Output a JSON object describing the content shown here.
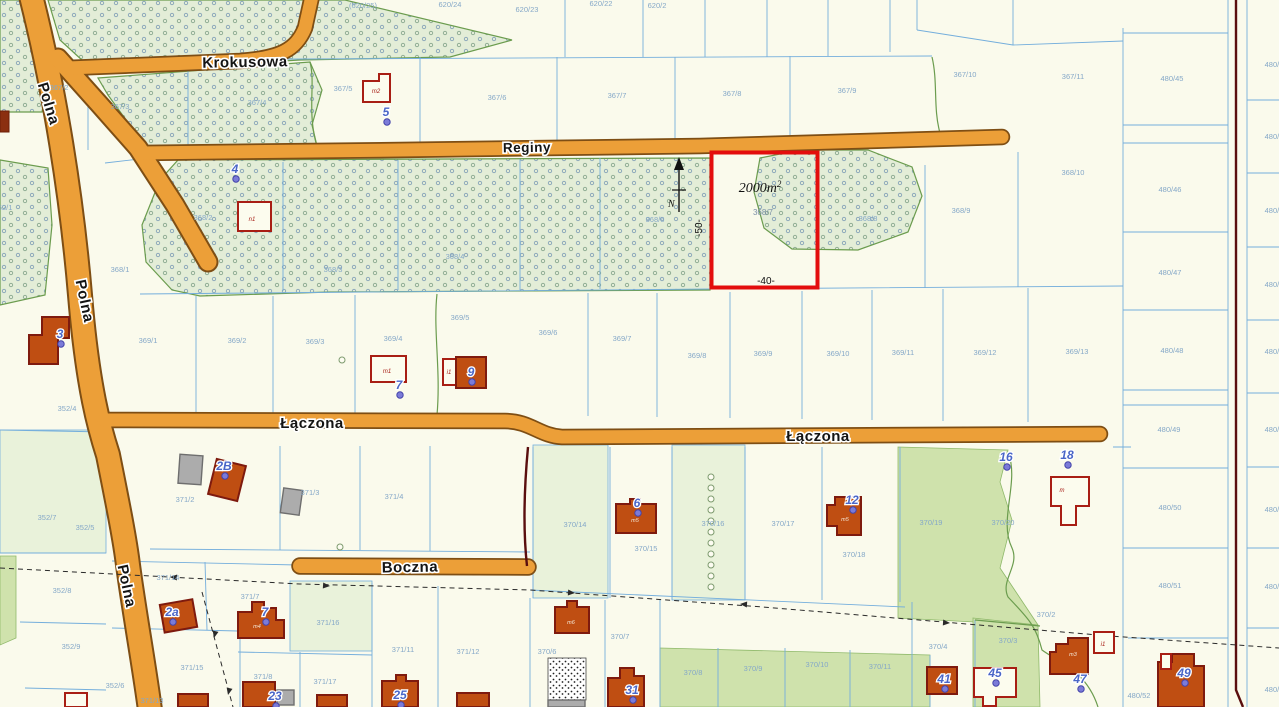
{
  "map": {
    "north": "N",
    "highlight": {
      "area": "2000m",
      "sup": "2",
      "parcel": "368/7",
      "width": "-40-",
      "depth": "-50-",
      "color": "#E30D0D"
    },
    "street_labels": [
      {
        "t": "Krokusowa",
        "x": 245,
        "y": 67,
        "r": -1,
        "s": 15
      },
      {
        "t": "Reginy",
        "x": 527,
        "y": 152,
        "r": -1,
        "s": 13.5
      },
      {
        "t": "Polna",
        "x": 44,
        "y": 105,
        "r": 73,
        "s": 15
      },
      {
        "t": "Polna",
        "x": 80,
        "y": 302,
        "r": 78,
        "s": 15
      },
      {
        "t": "Polna",
        "x": 122,
        "y": 587,
        "r": 78,
        "s": 15
      },
      {
        "t": "Łączona",
        "x": 312,
        "y": 428,
        "r": 0,
        "s": 15
      },
      {
        "t": "Łączona",
        "x": 818,
        "y": 441,
        "r": 0,
        "s": 15
      },
      {
        "t": "Boczna",
        "x": 410,
        "y": 572,
        "r": -1,
        "s": 15
      }
    ],
    "parcel_labels": [
      {
        "t": "(620/25)",
        "x": 363,
        "y": 8
      },
      {
        "t": "620/24",
        "x": 450,
        "y": 7
      },
      {
        "t": "620/23",
        "x": 527,
        "y": 12
      },
      {
        "t": "620/22",
        "x": 601,
        "y": 6
      },
      {
        "t": "620/2",
        "x": 657,
        "y": 8
      },
      {
        "t": "367/2",
        "x": 59,
        "y": 90
      },
      {
        "t": "367/3",
        "x": 120,
        "y": 109
      },
      {
        "t": "367/4",
        "x": 257,
        "y": 105
      },
      {
        "t": "367/5",
        "x": 343,
        "y": 91
      },
      {
        "t": "367/6",
        "x": 497,
        "y": 100
      },
      {
        "t": "367/7",
        "x": 617,
        "y": 98
      },
      {
        "t": "367/8",
        "x": 732,
        "y": 96
      },
      {
        "t": "367/9",
        "x": 847,
        "y": 93
      },
      {
        "t": "367/10",
        "x": 965,
        "y": 77
      },
      {
        "t": "367/11",
        "x": 1073,
        "y": 79
      },
      {
        "t": "368/1",
        "x": 120,
        "y": 272
      },
      {
        "t": "368/2",
        "x": 203,
        "y": 220
      },
      {
        "t": "368/3",
        "x": 333,
        "y": 272
      },
      {
        "t": "368/4",
        "x": 455,
        "y": 259
      },
      {
        "t": "368/6",
        "x": 655,
        "y": 222
      },
      {
        "t": "368/8",
        "x": 868,
        "y": 221
      },
      {
        "t": "368/9",
        "x": 961,
        "y": 213
      },
      {
        "t": "368/10",
        "x": 1073,
        "y": 175
      },
      {
        "t": "369/1",
        "x": 148,
        "y": 343
      },
      {
        "t": "369/2",
        "x": 237,
        "y": 343
      },
      {
        "t": "369/3",
        "x": 315,
        "y": 344
      },
      {
        "t": "369/4",
        "x": 393,
        "y": 341
      },
      {
        "t": "369/5",
        "x": 460,
        "y": 320
      },
      {
        "t": "369/6",
        "x": 548,
        "y": 335
      },
      {
        "t": "369/7",
        "x": 622,
        "y": 341
      },
      {
        "t": "369/8",
        "x": 697,
        "y": 358
      },
      {
        "t": "369/9",
        "x": 763,
        "y": 356
      },
      {
        "t": "369/10",
        "x": 838,
        "y": 356
      },
      {
        "t": "369/11",
        "x": 903,
        "y": 355
      },
      {
        "t": "369/12",
        "x": 985,
        "y": 355
      },
      {
        "t": "369/13",
        "x": 1077,
        "y": 354
      },
      {
        "t": "480/45",
        "x": 1172,
        "y": 81
      },
      {
        "t": "480/46",
        "x": 1170,
        "y": 192
      },
      {
        "t": "480/47",
        "x": 1170,
        "y": 275
      },
      {
        "t": "480/48",
        "x": 1172,
        "y": 353
      },
      {
        "t": "480/49",
        "x": 1169,
        "y": 432
      },
      {
        "t": "480/50",
        "x": 1170,
        "y": 510
      },
      {
        "t": "480/51",
        "x": 1170,
        "y": 588
      },
      {
        "t": "480/52",
        "x": 1139,
        "y": 698
      },
      {
        "t": "480/4",
        "x": 1274,
        "y": 67
      },
      {
        "t": "480/4",
        "x": 1274,
        "y": 139
      },
      {
        "t": "480/4",
        "x": 1274,
        "y": 213
      },
      {
        "t": "480/4",
        "x": 1274,
        "y": 287
      },
      {
        "t": "480/4",
        "x": 1274,
        "y": 354
      },
      {
        "t": "480/4",
        "x": 1274,
        "y": 432
      },
      {
        "t": "480/4",
        "x": 1274,
        "y": 512
      },
      {
        "t": "480/4",
        "x": 1274,
        "y": 589
      },
      {
        "t": "480/6",
        "x": 1274,
        "y": 692
      },
      {
        "t": "352/1",
        "x": 3,
        "y": 210
      },
      {
        "t": "352/4",
        "x": 67,
        "y": 411
      },
      {
        "t": "352/7",
        "x": 47,
        "y": 520
      },
      {
        "t": "352/5",
        "x": 85,
        "y": 530
      },
      {
        "t": "352/8",
        "x": 62,
        "y": 593
      },
      {
        "t": "352/9",
        "x": 71,
        "y": 649
      },
      {
        "t": "352/6",
        "x": 115,
        "y": 688
      },
      {
        "t": "371/2",
        "x": 185,
        "y": 502
      },
      {
        "t": "371/3",
        "x": 310,
        "y": 495
      },
      {
        "t": "371/4",
        "x": 394,
        "y": 499
      },
      {
        "t": "371/14",
        "x": 168,
        "y": 580
      },
      {
        "t": "371/7",
        "x": 250,
        "y": 599
      },
      {
        "t": "371/16",
        "x": 328,
        "y": 625
      },
      {
        "t": "371/11",
        "x": 403,
        "y": 652
      },
      {
        "t": "371/12",
        "x": 468,
        "y": 654
      },
      {
        "t": "371/15",
        "x": 192,
        "y": 670
      },
      {
        "t": "371/8",
        "x": 263,
        "y": 679
      },
      {
        "t": "371/17",
        "x": 325,
        "y": 684
      },
      {
        "t": "371/13",
        "x": 152,
        "y": 703
      },
      {
        "t": "370/14",
        "x": 575,
        "y": 527
      },
      {
        "t": "370/15",
        "x": 646,
        "y": 551
      },
      {
        "t": "370/16",
        "x": 713,
        "y": 526
      },
      {
        "t": "370/17",
        "x": 783,
        "y": 526
      },
      {
        "t": "370/18",
        "x": 854,
        "y": 557
      },
      {
        "t": "370/19",
        "x": 931,
        "y": 525
      },
      {
        "t": "370/20",
        "x": 1003,
        "y": 525
      },
      {
        "t": "370/2",
        "x": 1046,
        "y": 617
      },
      {
        "t": "370/3",
        "x": 1008,
        "y": 643
      },
      {
        "t": "370/4",
        "x": 938,
        "y": 649
      },
      {
        "t": "370/6",
        "x": 547,
        "y": 654
      },
      {
        "t": "370/7",
        "x": 620,
        "y": 639
      },
      {
        "t": "370/8",
        "x": 693,
        "y": 675
      },
      {
        "t": "370/9",
        "x": 753,
        "y": 671
      },
      {
        "t": "370/10",
        "x": 817,
        "y": 667
      },
      {
        "t": "370/11",
        "x": 880,
        "y": 669
      }
    ],
    "house_numbers": [
      {
        "t": "5",
        "x": 386,
        "y": 116
      },
      {
        "t": "4",
        "x": 235,
        "y": 173
      },
      {
        "t": "3",
        "x": 60,
        "y": 338
      },
      {
        "t": "7",
        "x": 399,
        "y": 389
      },
      {
        "t": "9",
        "x": 471,
        "y": 376
      },
      {
        "t": "2B",
        "x": 224,
        "y": 470
      },
      {
        "t": "6",
        "x": 637,
        "y": 507
      },
      {
        "t": "12",
        "x": 852,
        "y": 504
      },
      {
        "t": "16",
        "x": 1006,
        "y": 461
      },
      {
        "t": "18",
        "x": 1067,
        "y": 459
      },
      {
        "t": "2a",
        "x": 172,
        "y": 616
      },
      {
        "t": "7",
        "x": 265,
        "y": 616
      },
      {
        "t": "23",
        "x": 275,
        "y": 700
      },
      {
        "t": "25",
        "x": 400,
        "y": 699
      },
      {
        "t": "31",
        "x": 632,
        "y": 694
      },
      {
        "t": "41",
        "x": 944,
        "y": 683
      },
      {
        "t": "45",
        "x": 995,
        "y": 677
      },
      {
        "t": "47",
        "x": 1080,
        "y": 683
      },
      {
        "t": "49",
        "x": 1184,
        "y": 677
      }
    ],
    "building_labels": [
      {
        "t": "m2",
        "x": 376,
        "y": 93,
        "c": "r"
      },
      {
        "t": "n1",
        "x": 252,
        "y": 221,
        "c": "r"
      },
      {
        "t": "m1",
        "x": 387,
        "y": 373,
        "c": "r"
      },
      {
        "t": "i1",
        "x": 449,
        "y": 374,
        "c": "r"
      },
      {
        "t": "m",
        "x": 1062,
        "y": 492,
        "c": "r"
      },
      {
        "t": "i1",
        "x": 1103,
        "y": 646,
        "c": "r"
      },
      {
        "t": "m5",
        "x": 635,
        "y": 522,
        "c": "w"
      },
      {
        "t": "m5",
        "x": 845,
        "y": 521,
        "c": "w"
      },
      {
        "t": "m4",
        "x": 257,
        "y": 628,
        "c": "w"
      },
      {
        "t": "m6",
        "x": 571,
        "y": 624,
        "c": "w"
      },
      {
        "t": "m3",
        "x": 1073,
        "y": 656,
        "c": "w"
      }
    ],
    "survey_circles": [
      {
        "x": 342,
        "y": 360
      },
      {
        "x": 340,
        "y": 547
      },
      {
        "x": 711,
        "y": 477
      },
      {
        "x": 711,
        "y": 488
      },
      {
        "x": 711,
        "y": 499
      },
      {
        "x": 711,
        "y": 510
      },
      {
        "x": 711,
        "y": 521
      },
      {
        "x": 711,
        "y": 532
      },
      {
        "x": 711,
        "y": 543
      },
      {
        "x": 711,
        "y": 554
      },
      {
        "x": 711,
        "y": 565
      },
      {
        "x": 711,
        "y": 576
      },
      {
        "x": 711,
        "y": 587
      }
    ],
    "colors": {
      "road_fill": "#EC9F38",
      "road_edge": "#7E4E14",
      "parcel_line": "#74AEDC",
      "veg_line": "#6B9C4E",
      "building": "#BF4E12",
      "highlight": "#E30D0D",
      "house_number": "#4A66C8",
      "background": "#FAFAEC",
      "boundary_dark_red": "#5A0E0E"
    }
  }
}
